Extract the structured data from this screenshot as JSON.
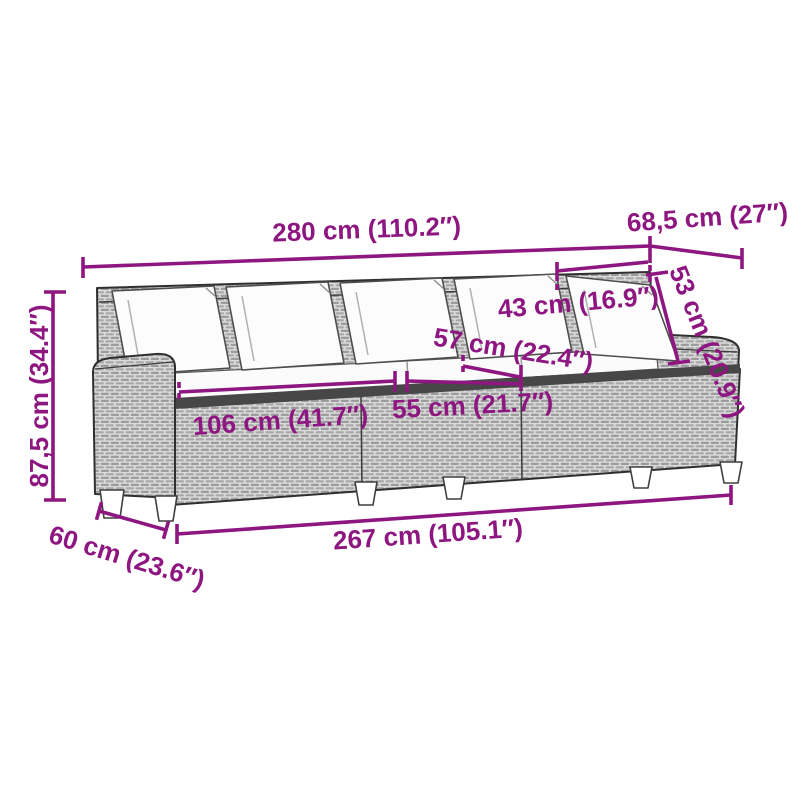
{
  "diagram": {
    "accent_color": "#8E1680",
    "dimensions": {
      "overall_width": "280 cm (110.2″)",
      "overall_depth": "68,5 cm (27″)",
      "backrest_height": "53 cm (20.9″)",
      "back_cushion_width": "43 cm (16.9″)",
      "seat_depth": "57 cm (22.4″)",
      "middle_seat_width": "55 cm (21.7″)",
      "side_seat_width": "106 cm (41.7″)",
      "overall_height": "87,5 cm (34.4″)",
      "base_depth": "60 cm (23.6″)",
      "base_width": "267 cm (105.1″)"
    }
  }
}
